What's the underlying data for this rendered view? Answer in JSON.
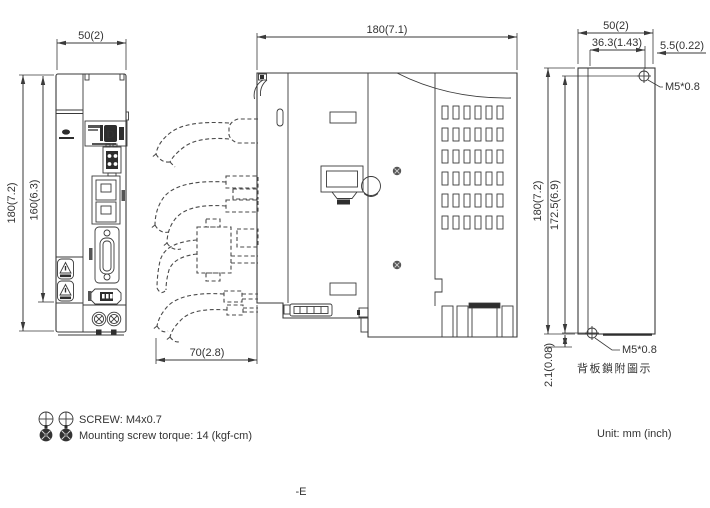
{
  "colors": {
    "line": "#3a3a3a",
    "text": "#333333",
    "dark": "#2e2e2e",
    "background": "#ffffff"
  },
  "front_view": {
    "width_dim": "50(2)",
    "height_dim": "180(7.2)",
    "inner_height_dim": "160(6.3)"
  },
  "side_view": {
    "depth_dim": "180(7.1)",
    "cable_clearance_dim": "70(2.8)"
  },
  "back_view": {
    "width_dim": "50(2)",
    "hole_offset_dim": "36.3(1.43)",
    "edge_offset_dim": "5.5(0.22)",
    "height_dim": "180(7.2)",
    "hole_span_dim": "172.5(6.9)",
    "bottom_offset_dim": "2.1(0.08)",
    "screw_top_label": "M5*0.8",
    "screw_bottom_label": "M5*0.8",
    "caption": "背板鎖附圖示"
  },
  "legend": {
    "screw_spec": "SCREW: M4x0.7",
    "torque_note": "Mounting screw torque: 14 (kgf-cm)"
  },
  "footer": {
    "unit_note": "Unit: mm (inch)",
    "model_suffix": "-E"
  }
}
